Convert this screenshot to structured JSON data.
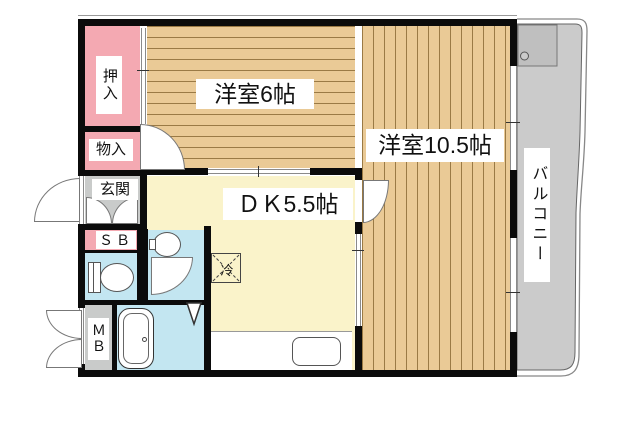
{
  "plan_title": "1DK apartment floor plan",
  "colors": {
    "wall": "#0b0b0b",
    "pink": "#f4a9b2",
    "gray": "#c9cbca",
    "balconyGray": "#cbcbcb",
    "balconyBox": "#bfbfbf",
    "blue": "#c3e6f1",
    "yellow": "#faf3ca",
    "wood": "#eaca96",
    "woodLine": "#9a7a45"
  },
  "rooms": {
    "room6": {
      "label": "洋室6帖"
    },
    "room10": {
      "label": "洋室10.5帖"
    },
    "dk": {
      "label": "ＤＫ5.5帖"
    },
    "oshiire": {
      "label": "押入"
    },
    "monoire": {
      "label": "物入"
    },
    "genkan": {
      "label": "玄関"
    },
    "sb": {
      "label": "ＳＢ"
    },
    "mb": {
      "label": "ＭＢ"
    },
    "balcony": {
      "label": "バルコニー"
    },
    "fridge": {
      "label": "冷"
    }
  }
}
